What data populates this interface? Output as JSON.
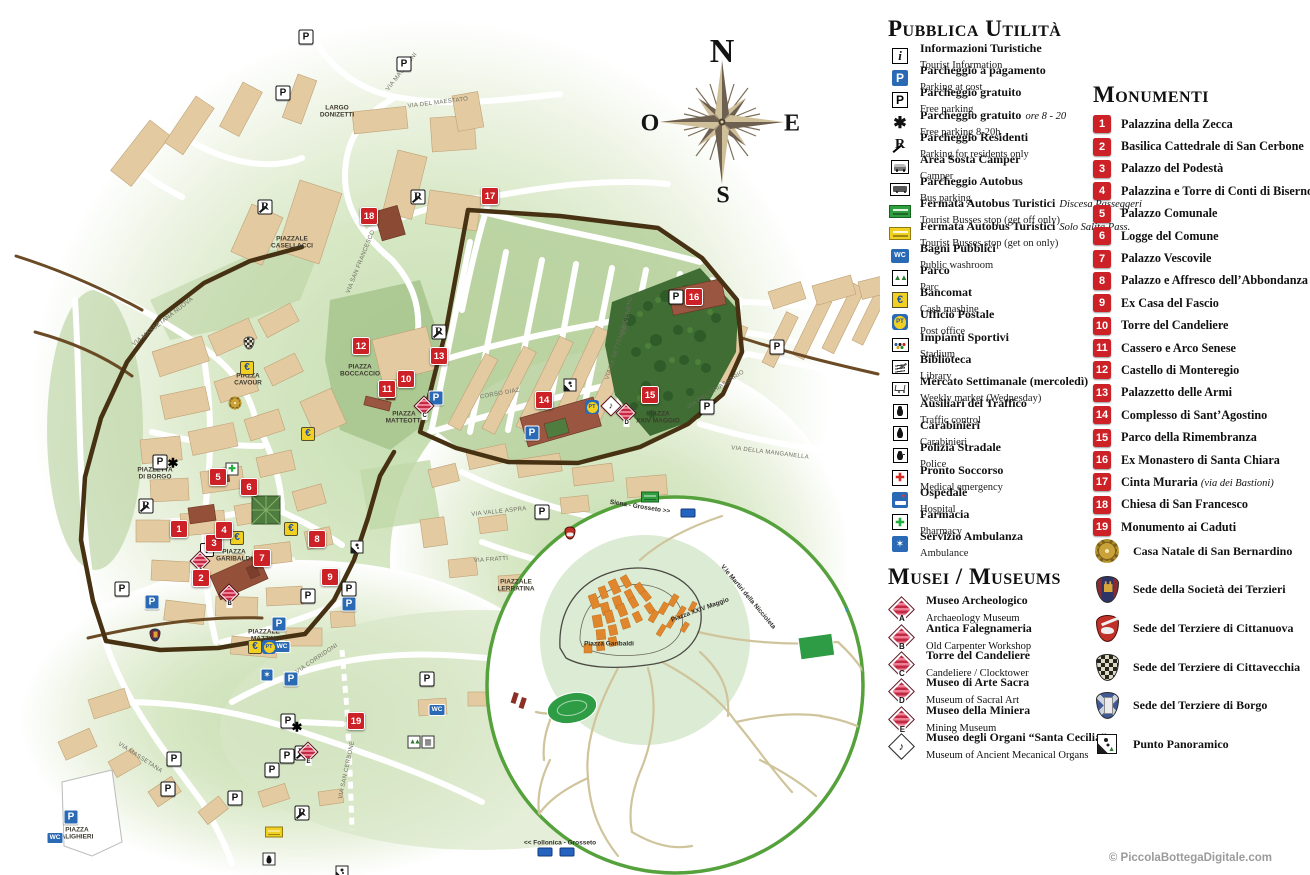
{
  "copyright": "© PiccolaBottegaDigitale.com",
  "compass": {
    "n": "N",
    "e": "E",
    "s": "S",
    "o": "O"
  },
  "public_utilities": {
    "title": "Pubblica Utilità",
    "items": [
      {
        "icon": "info",
        "glyph": "i",
        "it": "Informazioni Turistiche",
        "en": "Tourist Information"
      },
      {
        "icon": "paid",
        "glyph": "P",
        "it": "Parcheggio a pagamento",
        "en": "Parking at cost"
      },
      {
        "icon": "free",
        "glyph": "P",
        "it": "Parcheggio gratuito",
        "en": "Free parking"
      },
      {
        "icon": "hours",
        "glyph": "✱",
        "it": "Parcheggio gratuito",
        "note": "ore 8 - 20",
        "en": "Free parking 8-20h"
      },
      {
        "icon": "residents",
        "glyph": "R",
        "it": "Parcheggio Residenti",
        "en": "Parking for residents only"
      },
      {
        "icon": "camper",
        "glyph": "",
        "it": "Area Sosta Camper",
        "en": "Camper"
      },
      {
        "icon": "busp",
        "glyph": "",
        "it": "Parcheggio Autobus",
        "en": "Bus parking"
      },
      {
        "icon": "stopgreen",
        "glyph": "",
        "it": "Fermata Autobus Turistici",
        "note": "Discesa Passeggeri",
        "en": "Tourist Busses stop (get off only)"
      },
      {
        "icon": "stopyellow",
        "glyph": "",
        "it": "Fermata Autobus Turistici",
        "note": "Solo Salita Pass.",
        "en": "Tourist Busses stop (get on only)"
      },
      {
        "icon": "wcl",
        "glyph": "WC",
        "it": "Bagni Pubblici",
        "en": "Public washroom"
      },
      {
        "icon": "park",
        "glyph": "▲▲",
        "it": "Parco",
        "en": "Parc"
      },
      {
        "icon": "atm",
        "glyph": "€",
        "it": "Bancomat",
        "en": "Cash mashine"
      },
      {
        "icon": "post",
        "glyph": "PT",
        "it": "Ufficio Postale",
        "en": "Post office"
      },
      {
        "icon": "sports",
        "glyph": "",
        "it": "Impianti Sportivi",
        "en": "Stadium"
      },
      {
        "icon": "library",
        "glyph": "",
        "it": "Biblioteca",
        "en": "Library"
      },
      {
        "icon": "market",
        "glyph": "",
        "it": "Mercato Settimanale (mercoledì)",
        "en": "Weekly market (Wednesday)"
      },
      {
        "icon": "traffic",
        "glyph": "",
        "it": "Ausiliari del Traffico",
        "en": "Traffic control"
      },
      {
        "icon": "carabinieri",
        "glyph": "",
        "it": "Carabinieri",
        "en": "Carabinieri"
      },
      {
        "icon": "police",
        "glyph": "",
        "it": "Polizia Stradale",
        "en": "Police"
      },
      {
        "icon": "firstaid",
        "glyph": "✚",
        "it": "Pronto Soccorso",
        "en": "Medical emergency"
      },
      {
        "icon": "hospital",
        "glyph": "",
        "it": "Ospedale",
        "en": "Hospital"
      },
      {
        "icon": "pharmacy",
        "glyph": "✚",
        "it": "Farmacia",
        "en": "Pharmacy"
      },
      {
        "icon": "ambulance",
        "glyph": "✶",
        "it": "Servizio Ambulanza",
        "en": "Ambulance"
      }
    ]
  },
  "museums": {
    "title": "Musei / Museums",
    "items": [
      {
        "type": "stripes",
        "letter": "A",
        "it": "Museo Archeologico",
        "en": "Archaeology Museum"
      },
      {
        "type": "stripes",
        "letter": "B",
        "it": "Antica Falegnameria",
        "en": "Old Carpenter Workshop"
      },
      {
        "type": "stripes",
        "letter": "C",
        "it": "Torre del Candeliere",
        "en": "Candeliere / Clocktower"
      },
      {
        "type": "stripes",
        "letter": "D",
        "it": "Museo di Arte Sacra",
        "en": "Museum of Sacral Art"
      },
      {
        "type": "stripes",
        "letter": "E",
        "it": "Museo della Miniera",
        "en": "Mining Museum"
      },
      {
        "type": "organ",
        "letter": "",
        "it": "Museo degli Organi “Santa Cecilia”",
        "en": "Museum of Ancient Mecanical Organs"
      }
    ]
  },
  "monuments": {
    "title": "Monumenti",
    "items": [
      {
        "n": "1",
        "label": "Palazzina della Zecca",
        "note": ""
      },
      {
        "n": "2",
        "label": "Basilica Cattedrale di San Cerbone",
        "note": ""
      },
      {
        "n": "3",
        "label": "Palazzo del Podestà",
        "note": ""
      },
      {
        "n": "4",
        "label": "Palazzina e Torre di Conti di Biserno",
        "note": ""
      },
      {
        "n": "5",
        "label": "Palazzo Comunale",
        "note": ""
      },
      {
        "n": "6",
        "label": "Logge del Comune",
        "note": ""
      },
      {
        "n": "7",
        "label": "Palazzo Vescovile",
        "note": ""
      },
      {
        "n": "8",
        "label": "Palazzo e Affresco dell’Abbondanza",
        "note": ""
      },
      {
        "n": "9",
        "label": "Ex Casa del Fascio",
        "note": ""
      },
      {
        "n": "10",
        "label": "Torre del Candeliere",
        "note": ""
      },
      {
        "n": "11",
        "label": "Cassero e Arco Senese",
        "note": ""
      },
      {
        "n": "12",
        "label": "Castello di Monteregio",
        "note": ""
      },
      {
        "n": "13",
        "label": "Palazzetto delle Armi",
        "note": ""
      },
      {
        "n": "14",
        "label": "Complesso di Sant’Agostino",
        "note": ""
      },
      {
        "n": "15",
        "label": "Parco della Rimembranza",
        "note": ""
      },
      {
        "n": "16",
        "label": "Ex Monastero di Santa Chiara",
        "note": ""
      },
      {
        "n": "17",
        "label": "Cinta Muraria",
        "note": "(via dei Bastioni)"
      },
      {
        "n": "18",
        "label": "Chiesa di San Francesco",
        "note": ""
      },
      {
        "n": "19",
        "label": "Monumento ai Caduti",
        "note": ""
      }
    ]
  },
  "emblems": [
    {
      "type": "sun",
      "label": "Casa Natale di San Bernardino"
    },
    {
      "type": "castle",
      "label": "Sede della Società dei Terzieri"
    },
    {
      "type": "red",
      "label": "Sede del Terziere di Cittanuova"
    },
    {
      "type": "check",
      "label": "Sede del Terziere di Cittavecchia"
    },
    {
      "type": "tower",
      "label": "Sede del Terziere di Borgo"
    },
    {
      "type": "pan",
      "label": "Punto Panoramico"
    }
  ],
  "map": {
    "markers": [
      {
        "n": "1",
        "x": 179,
        "y": 529
      },
      {
        "n": "2",
        "x": 201,
        "y": 578
      },
      {
        "n": "3",
        "x": 214,
        "y": 543
      },
      {
        "n": "4",
        "x": 224,
        "y": 530
      },
      {
        "n": "5",
        "x": 218,
        "y": 477
      },
      {
        "n": "6",
        "x": 249,
        "y": 487
      },
      {
        "n": "7",
        "x": 262,
        "y": 558
      },
      {
        "n": "8",
        "x": 317,
        "y": 539
      },
      {
        "n": "9",
        "x": 330,
        "y": 577
      },
      {
        "n": "10",
        "x": 406,
        "y": 379
      },
      {
        "n": "11",
        "x": 387,
        "y": 389
      },
      {
        "n": "12",
        "x": 361,
        "y": 346
      },
      {
        "n": "13",
        "x": 439,
        "y": 356
      },
      {
        "n": "14",
        "x": 544,
        "y": 400
      },
      {
        "n": "15",
        "x": 650,
        "y": 395
      },
      {
        "n": "16",
        "x": 694,
        "y": 297
      },
      {
        "n": "17",
        "x": 490,
        "y": 196
      },
      {
        "n": "18",
        "x": 369,
        "y": 216
      },
      {
        "n": "19",
        "x": 356,
        "y": 721
      }
    ],
    "pins": [
      {
        "t": "pw",
        "g": "P",
        "l": "",
        "x": 306,
        "y": 37
      },
      {
        "t": "pw",
        "g": "P",
        "l": "",
        "x": 404,
        "y": 64
      },
      {
        "t": "pw",
        "g": "P",
        "l": "",
        "x": 283,
        "y": 93
      },
      {
        "t": "pw",
        "g": "P",
        "l": "",
        "x": 122,
        "y": 589
      },
      {
        "t": "pw",
        "g": "P",
        "l": "",
        "x": 308,
        "y": 596
      },
      {
        "t": "pw",
        "g": "P",
        "l": "",
        "x": 349,
        "y": 589
      },
      {
        "t": "pw",
        "g": "P",
        "l": "",
        "x": 676,
        "y": 297
      },
      {
        "t": "pw",
        "g": "P",
        "l": "",
        "x": 777,
        "y": 347
      },
      {
        "t": "pw",
        "g": "P",
        "l": "",
        "x": 707,
        "y": 407
      },
      {
        "t": "pw",
        "g": "P",
        "l": "",
        "x": 542,
        "y": 512
      },
      {
        "t": "pw",
        "g": "P",
        "l": "",
        "x": 174,
        "y": 759
      },
      {
        "t": "pw",
        "g": "P",
        "l": "",
        "x": 168,
        "y": 789
      },
      {
        "t": "pw",
        "g": "P",
        "l": "",
        "x": 235,
        "y": 798
      },
      {
        "t": "pw",
        "g": "P",
        "l": "",
        "x": 288,
        "y": 721
      },
      {
        "t": "pw",
        "g": "P",
        "l": "",
        "x": 287,
        "y": 756
      },
      {
        "t": "pw",
        "g": "P",
        "l": "",
        "x": 272,
        "y": 770
      },
      {
        "t": "pw",
        "g": "P",
        "l": "",
        "x": 427,
        "y": 679
      },
      {
        "t": "pw",
        "g": "P",
        "l": "",
        "x": 160,
        "y": 462
      },
      {
        "t": "pb",
        "g": "P",
        "l": "",
        "x": 152,
        "y": 602
      },
      {
        "t": "pb",
        "g": "P",
        "l": "",
        "x": 279,
        "y": 624
      },
      {
        "t": "pb",
        "g": "P",
        "l": "",
        "x": 349,
        "y": 604
      },
      {
        "t": "pb",
        "g": "P",
        "l": "",
        "x": 436,
        "y": 398
      },
      {
        "t": "pb",
        "g": "P",
        "l": "",
        "x": 532,
        "y": 433
      },
      {
        "t": "pb",
        "g": "P",
        "l": "",
        "x": 71,
        "y": 817
      },
      {
        "t": "pb",
        "g": "P",
        "l": "",
        "x": 291,
        "y": 679
      },
      {
        "t": "in",
        "g": "i",
        "l": "",
        "x": 207,
        "y": 550
      },
      {
        "t": "wc",
        "g": "WC",
        "l": "",
        "x": 282,
        "y": 647
      },
      {
        "t": "wc",
        "g": "WC",
        "l": "",
        "x": 437,
        "y": 710
      },
      {
        "t": "wc",
        "g": "WC",
        "l": "",
        "x": 55,
        "y": 838
      },
      {
        "t": "eu",
        "g": "€",
        "l": "",
        "x": 247,
        "y": 368
      },
      {
        "t": "eu",
        "g": "€",
        "l": "",
        "x": 308,
        "y": 434
      },
      {
        "t": "eu",
        "g": "€",
        "l": "",
        "x": 291,
        "y": 529
      },
      {
        "t": "eu",
        "g": "€",
        "l": "",
        "x": 237,
        "y": 538
      },
      {
        "t": "eu",
        "g": "€",
        "l": "",
        "x": 255,
        "y": 647
      },
      {
        "t": "pt",
        "g": "PT",
        "l": "",
        "x": 269,
        "y": 647
      },
      {
        "t": "pt",
        "g": "PT",
        "l": "",
        "x": 592,
        "y": 407
      },
      {
        "t": "rr",
        "g": "R",
        "l": "",
        "x": 265,
        "y": 207
      },
      {
        "t": "rr",
        "g": "R",
        "l": "",
        "x": 418,
        "y": 182
      },
      {
        "t": "rr",
        "g": "R",
        "l": "",
        "x": 439,
        "y": 302
      },
      {
        "t": "rr",
        "g": "R",
        "l": "",
        "x": 146,
        "y": 461
      },
      {
        "t": "rr",
        "g": "R",
        "l": "",
        "x": 302,
        "y": 693
      },
      {
        "t": "rr",
        "g": "R",
        "l": "",
        "x": 302,
        "y": 738
      },
      {
        "t": "st",
        "g": "✱",
        "l": "",
        "x": 173,
        "y": 463
      },
      {
        "t": "st",
        "g": "✱",
        "l": "",
        "x": 297,
        "y": 727
      },
      {
        "t": "fc",
        "g": "✚",
        "l": "",
        "x": 232,
        "y": 469
      },
      {
        "t": "bg",
        "g": "",
        "l": "",
        "x": 650,
        "y": 407
      },
      {
        "t": "by",
        "g": "",
        "l": "",
        "x": 274,
        "y": 731
      },
      {
        "t": "am",
        "g": "✶",
        "l": "",
        "x": 267,
        "y": 675
      },
      {
        "t": "tc",
        "g": "",
        "l": "",
        "x": 269,
        "y": 747
      },
      {
        "t": "mu",
        "g": "",
        "l": "A",
        "x": 200,
        "y": 561
      },
      {
        "t": "mu",
        "g": "",
        "l": "B",
        "x": 229,
        "y": 594
      },
      {
        "t": "mu",
        "g": "",
        "l": "C",
        "x": 424,
        "y": 406
      },
      {
        "t": "mu",
        "g": "",
        "l": "D",
        "x": 626,
        "y": 413
      },
      {
        "t": "mu",
        "g": "",
        "l": "E",
        "x": 308,
        "y": 752
      },
      {
        "t": "or",
        "g": "♪",
        "l": "",
        "x": 611,
        "y": 406
      },
      {
        "t": "cs",
        "g": "",
        "l": "",
        "x": 235,
        "y": 403
      },
      {
        "t": "cc",
        "g": "",
        "l": "",
        "x": 249,
        "y": 343
      },
      {
        "t": "ck",
        "g": "",
        "l": "",
        "x": 155,
        "y": 510
      },
      {
        "t": "cr",
        "g": "",
        "l": "",
        "x": 570,
        "y": 395
      },
      {
        "t": "pp",
        "g": "",
        "l": "",
        "x": 342,
        "y": 721
      },
      {
        "t": "pp",
        "g": "",
        "l": "",
        "x": 357,
        "y": 383
      },
      {
        "t": "pp",
        "g": "",
        "l": "",
        "x": 570,
        "y": 208
      },
      {
        "t": "tr",
        "g": "▲▲",
        "l": "",
        "x": 414,
        "y": 742
      },
      {
        "t": "mk",
        "g": "▦",
        "l": "",
        "x": 428,
        "y": 742
      },
      {
        "t": "sh",
        "g": "",
        "l": "",
        "x": 688,
        "y": 513
      },
      {
        "t": "sh",
        "g": "",
        "l": "",
        "x": 545,
        "y": 852
      },
      {
        "t": "sh",
        "g": "",
        "l": "",
        "x": 567,
        "y": 852
      }
    ],
    "piazza_labels": [
      {
        "text": "Largo\nDonizetti",
        "x": 337,
        "y": 112
      },
      {
        "text": "Piazzale\nCasellacci",
        "x": 292,
        "y": 243
      },
      {
        "text": "Piazza\nCavour",
        "x": 248,
        "y": 380
      },
      {
        "text": "Piazza\nBoccaccio",
        "x": 360,
        "y": 371
      },
      {
        "text": "Piazza\nMatteotti",
        "x": 404,
        "y": 418
      },
      {
        "text": "Piazzetta\ndi Borgo",
        "x": 155,
        "y": 474
      },
      {
        "text": "Piazza\nGaribaldi",
        "x": 234,
        "y": 556
      },
      {
        "text": "Piazzale\nMazzini",
        "x": 264,
        "y": 636
      },
      {
        "text": "Piazza\nXXIV Maggio",
        "x": 658,
        "y": 418
      },
      {
        "text": "Piazzale\nLerratina",
        "x": 516,
        "y": 586
      },
      {
        "text": "Piazza\nAlighieri",
        "x": 77,
        "y": 834
      }
    ],
    "street_labels": [
      {
        "text": "Via del Maestato",
        "x": 438,
        "y": 103,
        "rot": -7
      },
      {
        "text": "Via Mascagni",
        "x": 402,
        "y": 72,
        "rot": -52
      },
      {
        "text": "Via San Francesco",
        "x": 361,
        "y": 262,
        "rot": -68
      },
      {
        "text": "Via Massetana Nuova",
        "x": 163,
        "y": 322,
        "rot": -38
      },
      {
        "text": "Corso Diaz",
        "x": 500,
        "y": 394,
        "rot": -10
      },
      {
        "text": "Via XX Settembre",
        "x": 617,
        "y": 350,
        "rot": -72
      },
      {
        "text": "Via Veneto",
        "x": 628,
        "y": 316,
        "rot": -80
      },
      {
        "text": "Via del Chiassario",
        "x": 716,
        "y": 390,
        "rot": -33
      },
      {
        "text": "Via della Manganella",
        "x": 770,
        "y": 453,
        "rot": 7
      },
      {
        "text": "Via Valle Aspra",
        "x": 499,
        "y": 512,
        "rot": -6
      },
      {
        "text": "Via Fratti",
        "x": 491,
        "y": 560,
        "rot": -4
      },
      {
        "text": "Via Corridoni",
        "x": 317,
        "y": 659,
        "rot": -34
      },
      {
        "text": "Via San Cerbone",
        "x": 347,
        "y": 770,
        "rot": -78
      },
      {
        "text": "Via Massetana",
        "x": 140,
        "y": 758,
        "rot": 33
      }
    ],
    "inset_labels": [
      {
        "text": "Siena - Grosseto >>",
        "x": 640,
        "y": 507,
        "rot": 9
      },
      {
        "text": "<< Follonica - Grosseto",
        "x": 560,
        "y": 843,
        "rot": 0
      },
      {
        "text": "V.le Martiri della Niccioleta",
        "x": 748,
        "y": 597,
        "rot": 50
      },
      {
        "text": "Piazza Garibaldi",
        "x": 609,
        "y": 644,
        "rot": 0
      },
      {
        "text": "Piazza XXIV Maggio",
        "x": 700,
        "y": 610,
        "rot": -20
      }
    ]
  }
}
